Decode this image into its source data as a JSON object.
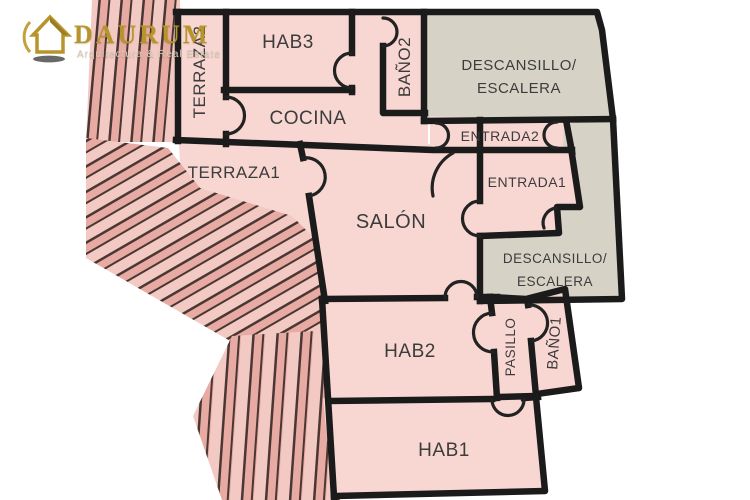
{
  "brand": {
    "name": "DAURUM",
    "tagline": "Arquitectura & Real Estate",
    "icon": "house-icon"
  },
  "colors": {
    "room_fill": "#f8d7d2",
    "landing_fill": "#d6d2c6",
    "wall": "#1b1b1b",
    "label_text": "#3c3c3c",
    "brand_gold": "#b6952c",
    "decor_stripe_dark": "#4a3733",
    "decor_stripe_mid": "#e8aba3",
    "decor_stripe_light": "#f3cac3"
  },
  "rooms": {
    "terraza2": "TERRAZA2",
    "hab3": "HAB3",
    "bano2": "BAÑO2",
    "descansillo_top_line1": "DESCANSILLO/",
    "descansillo_top_line2": "ESCALERA",
    "cocina": "COCINA",
    "entrada2": "ENTRADA2",
    "entrada1": "ENTRADA1",
    "terraza1": "TERRAZA1",
    "salon": "SALÓN",
    "descansillo_bottom_line1": "DESCANSILLO/",
    "descansillo_bottom_line2": "ESCALERA",
    "hab2": "HAB2",
    "pasillo": "PASILLO",
    "bano1": "BAÑO1",
    "hab1": "HAB1"
  }
}
